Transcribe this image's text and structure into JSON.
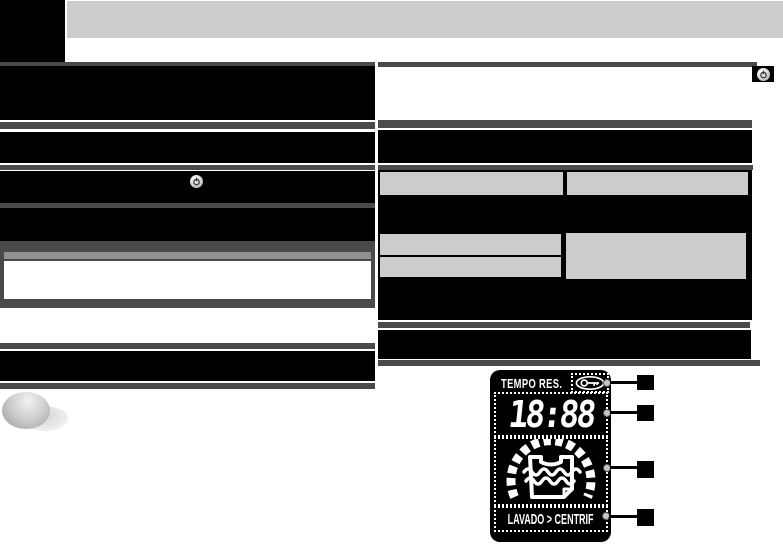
{
  "page": {
    "width": 783,
    "height": 548,
    "background": "#ffffff"
  },
  "colors": {
    "header_bar": "#cccccc",
    "section_bar": "#4a4a4a",
    "redacted_block": "#000000",
    "table_cell": "#cccccc",
    "note_strip": "#919191",
    "display_background": "#000000",
    "display_foreground": "#ffffff"
  },
  "display": {
    "title": "TEMPO RES.",
    "time": "18:88",
    "status": "LAVADO > CENTRIF",
    "icons": {
      "key": "key-in-ellipse-icon",
      "progress": "segmented-progress-arc",
      "drum": "laundry-garment-water-icon"
    }
  },
  "icons": {
    "power_button_left": "power-button-icon",
    "power_button_right": "power-button-icon"
  },
  "callouts": {
    "count": 4,
    "labels": [
      "",
      "",
      "",
      ""
    ]
  }
}
